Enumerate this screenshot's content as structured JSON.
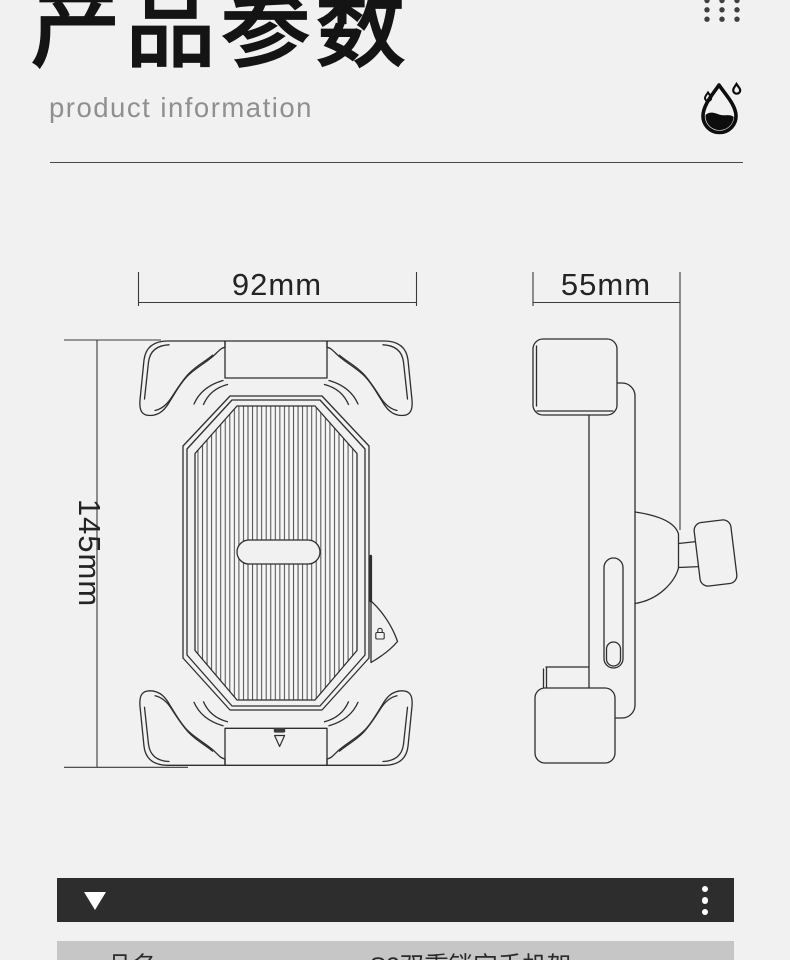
{
  "header": {
    "title": "产品参数",
    "subtitle": "product information"
  },
  "diagram": {
    "front_view": {
      "width_label": "92mm",
      "height_label": "145mm"
    },
    "side_view": {
      "width_label": "55mm"
    }
  },
  "spec_table": {
    "rows": [
      {
        "label": "品名",
        "value": "S2双重锁定手机架"
      }
    ]
  },
  "icons": {
    "top_right": [
      "dots-grid",
      "waterproof-drop"
    ],
    "bar_left": "triangle-down",
    "bar_right": "kebab-dots"
  },
  "colors": {
    "page_bg": "#f2f1f1",
    "title_text": "#141414",
    "subtitle_text": "#8f8f8f",
    "drawing_line": "#2e2e2e",
    "section_bar_bg": "#2d2d2d",
    "table_row_bg": "#c6c6c6"
  }
}
